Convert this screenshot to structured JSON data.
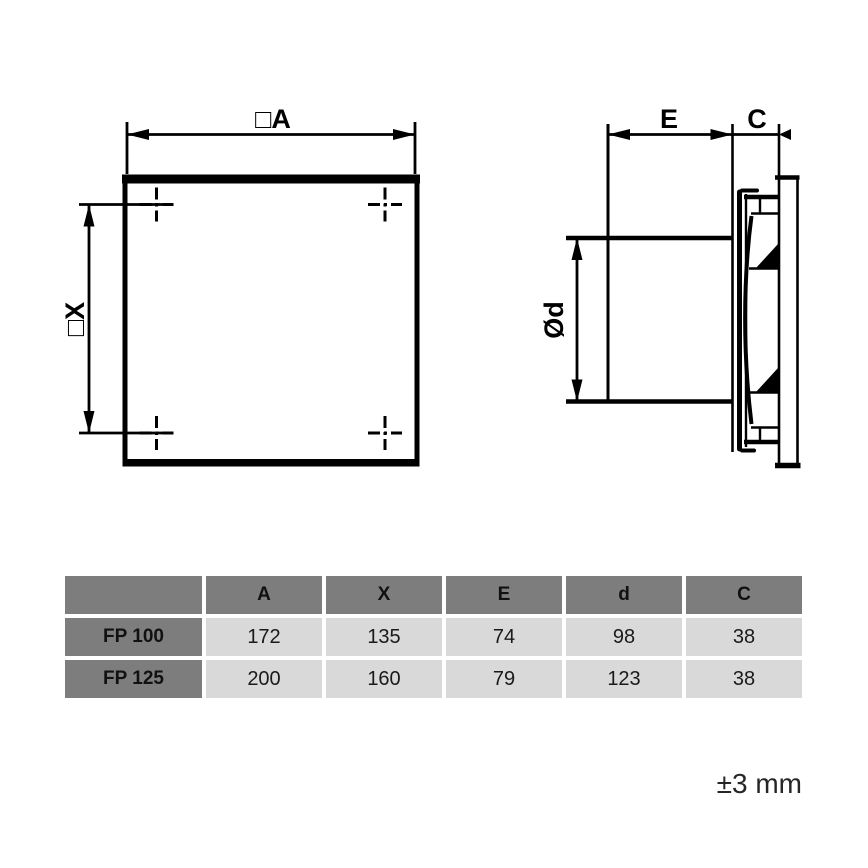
{
  "drawing": {
    "front_view": {
      "width_label": "□A",
      "height_label": "□X"
    },
    "side_view": {
      "duct_length_label": "E",
      "front_depth_label": "C",
      "duct_diameter_label": "Ød"
    },
    "tolerance_note": "±3 mm"
  },
  "table": {
    "headers": {
      "model": "",
      "a": "A",
      "x": "X",
      "e": "E",
      "d": "d",
      "c": "C"
    },
    "rows": [
      {
        "model": "FP 100",
        "a": "172",
        "x": "135",
        "e": "74",
        "d": "98",
        "c": "38"
      },
      {
        "model": "FP 125",
        "a": "200",
        "x": "160",
        "e": "79",
        "d": "123",
        "c": "38"
      }
    ]
  },
  "colors": {
    "line": "#000000",
    "header_cell": "#7d7d7d",
    "data_cell": "#d9d9d9",
    "page_background": "#ffffff",
    "text": "#1a1a1a"
  }
}
